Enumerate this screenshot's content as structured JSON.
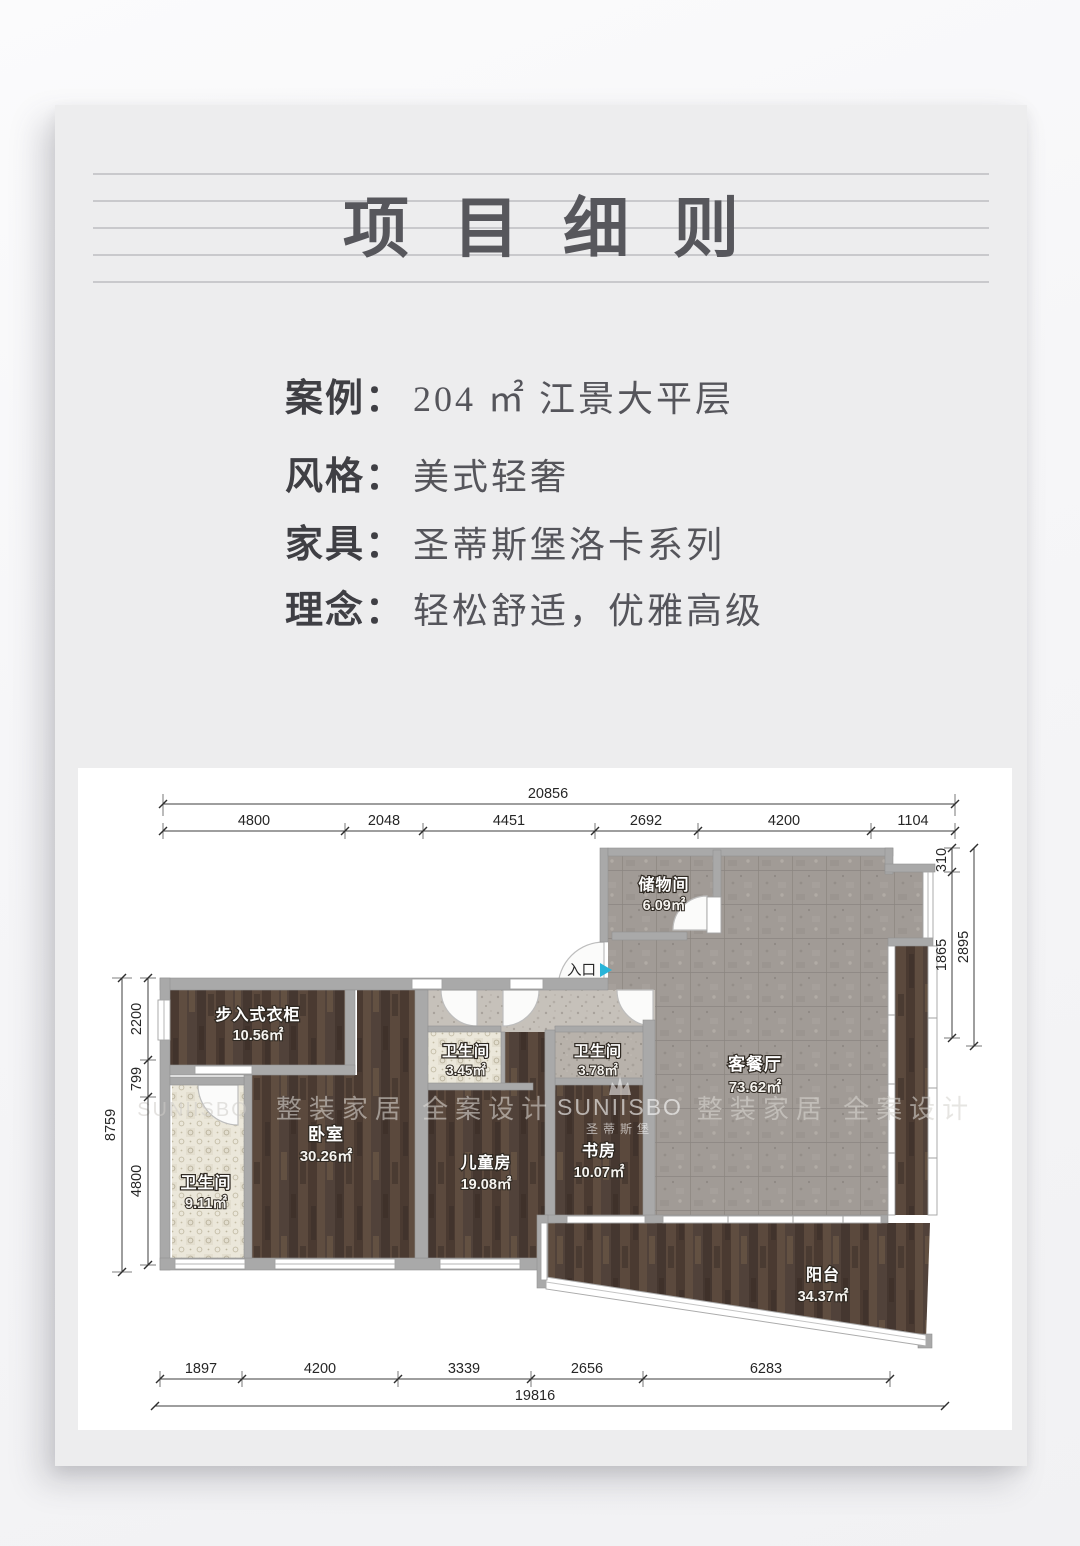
{
  "title": "项目细则",
  "info": {
    "rows": [
      {
        "label": "案例：",
        "value": "204 ㎡ 江景大平层"
      },
      {
        "label": "风格：",
        "value": "美式轻奢"
      },
      {
        "label": "家具：",
        "value": "圣蒂斯堡洛卡系列"
      },
      {
        "label": "理念：",
        "value": "轻松舒适，优雅高级"
      }
    ]
  },
  "plan": {
    "entry_label": "入口",
    "rooms": [
      {
        "name": "储物间",
        "area": "6.09㎡"
      },
      {
        "name": "客餐厅",
        "area": "73.62㎡"
      },
      {
        "name": "步入式衣柜",
        "area": "10.56㎡"
      },
      {
        "name": "卧室",
        "area": "30.26㎡"
      },
      {
        "name": "卫生间",
        "area": "9.11㎡"
      },
      {
        "name": "卫生间",
        "area": "3.45㎡"
      },
      {
        "name": "卫生间",
        "area": "3.78㎡"
      },
      {
        "name": "儿童房",
        "area": "19.08㎡"
      },
      {
        "name": "书房",
        "area": "10.07㎡"
      },
      {
        "name": "阳台",
        "area": "34.37㎡"
      }
    ],
    "dims": {
      "top": {
        "total": "20856",
        "segments": [
          "4800",
          "2048",
          "4451",
          "2692",
          "4200",
          "1104"
        ]
      },
      "bottom": {
        "total": "19816",
        "segments": [
          "1897",
          "4200",
          "3339",
          "2656",
          "6283"
        ]
      },
      "left": {
        "total": "8759",
        "segments": [
          "2200",
          "799",
          "4800"
        ]
      },
      "right": {
        "total": "2895",
        "segments": [
          "310",
          "1865"
        ]
      }
    },
    "watermark": {
      "slogan_left": "整装家居 全案设计",
      "slogan_right": "整装家居 全案设计",
      "brand": "SUNIISBO",
      "brand_cn": "圣蒂斯堡",
      "brand_faint": "SUNIISBO"
    }
  },
  "colors": {
    "entry_arrow": "#29b4d8",
    "wall": "#a9a9a9",
    "card_bg": "#ededee",
    "title_line": "#c9c9cc"
  }
}
